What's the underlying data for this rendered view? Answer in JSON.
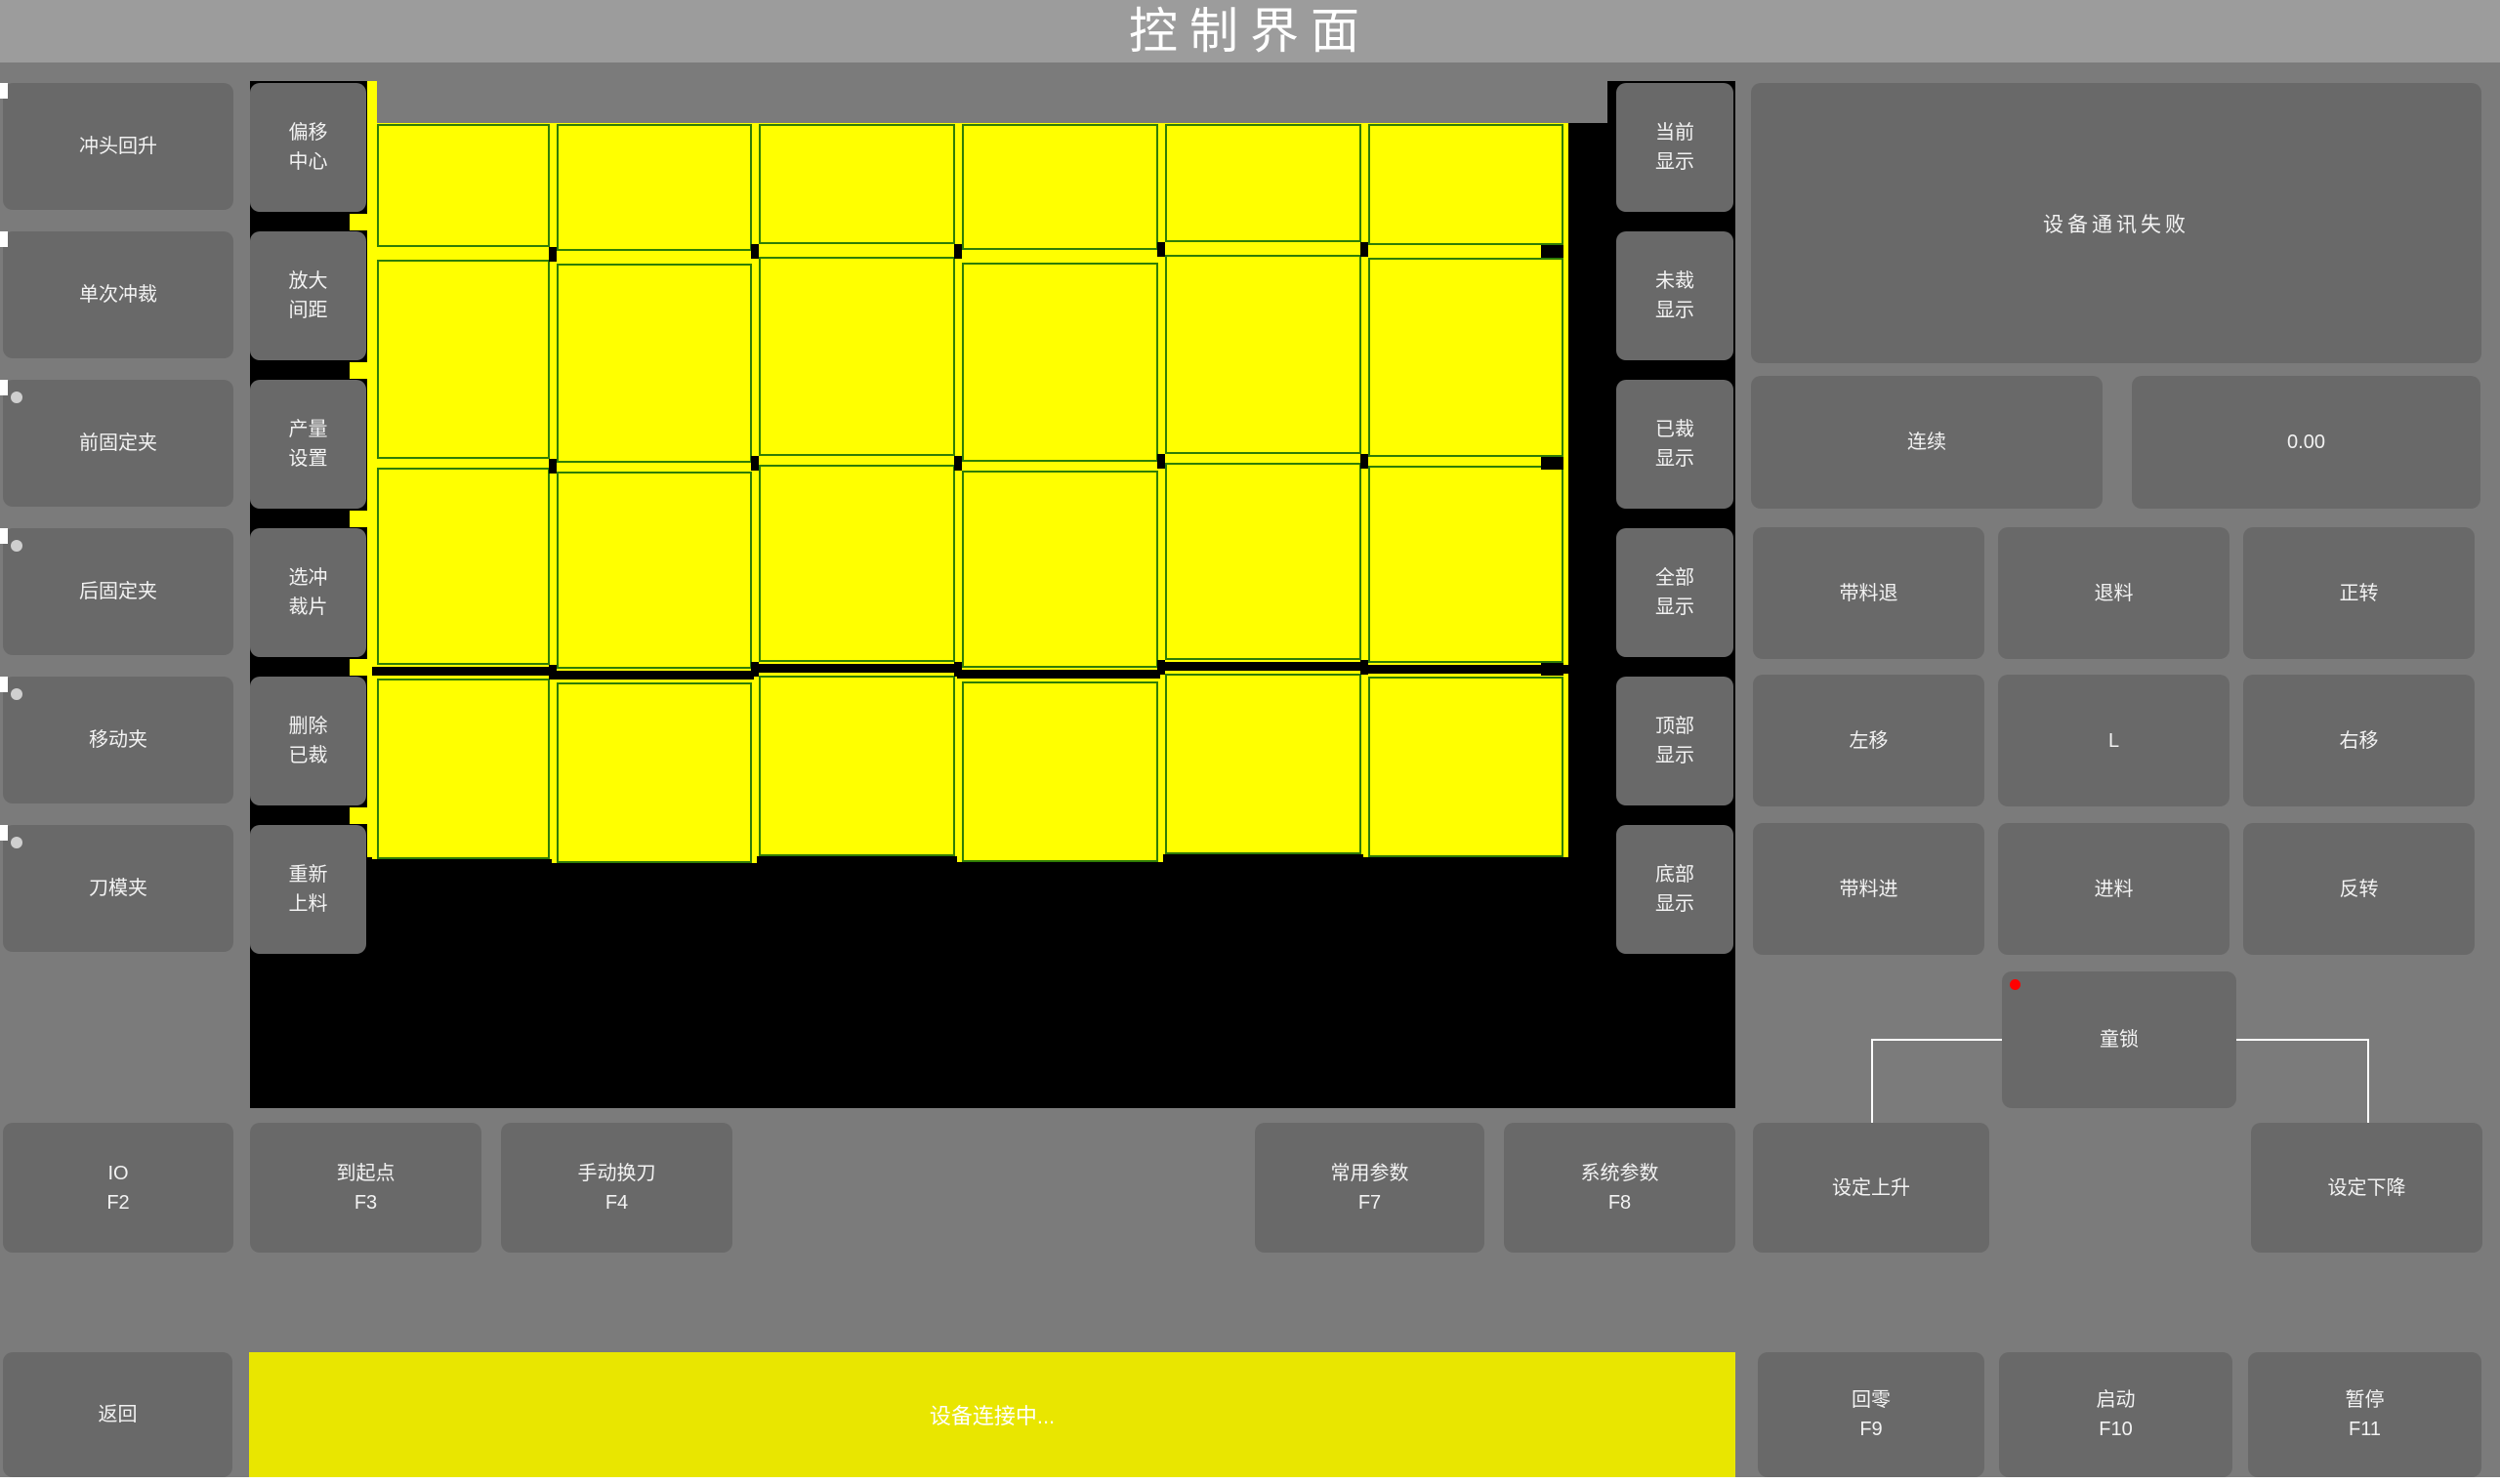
{
  "window": {
    "title": "控制界面"
  },
  "colors": {
    "accent_yellow": "#ffff00",
    "status_bar_yellow": "#e9e600",
    "grid_line_green": "#2f7d05",
    "canvas_black": "#000000",
    "button_gray": "#696969",
    "alarm_red": "#ff0000",
    "indicator_gray": "#cfcfcf"
  },
  "left_buttons": [
    {
      "label": "冲头回升",
      "dot": false
    },
    {
      "label": "单次冲裁",
      "dot": false
    },
    {
      "label": "前固定夹",
      "dot": true
    },
    {
      "label": "后固定夹",
      "dot": true
    },
    {
      "label": "移动夹",
      "dot": true
    },
    {
      "label": "刀模夹",
      "dot": true
    }
  ],
  "tool_buttons": [
    {
      "lines": [
        "偏移",
        "中心"
      ]
    },
    {
      "lines": [
        "放大",
        "间距"
      ]
    },
    {
      "lines": [
        "产量",
        "设置"
      ]
    },
    {
      "lines": [
        "选冲",
        "裁片"
      ]
    },
    {
      "lines": [
        "删除",
        "已裁"
      ]
    },
    {
      "lines": [
        "重新",
        "上料"
      ]
    }
  ],
  "display_buttons": [
    {
      "lines": [
        "当前",
        "显示"
      ]
    },
    {
      "lines": [
        "未裁",
        "显示"
      ]
    },
    {
      "lines": [
        "已裁",
        "显示"
      ]
    },
    {
      "lines": [
        "全部",
        "显示"
      ]
    },
    {
      "lines": [
        "顶部",
        "显示"
      ]
    },
    {
      "lines": [
        "底部",
        "显示"
      ]
    }
  ],
  "piece_grid": {
    "columns": 6,
    "rows": 4
  },
  "right_panel": {
    "message": "设备通讯失败",
    "mode_button": "连续",
    "value_display": "0.00",
    "jog_grid": [
      [
        "带料退",
        "退料",
        "正转"
      ],
      [
        "左移",
        "L",
        "右移"
      ],
      [
        "带料进",
        "进料",
        "反转"
      ]
    ],
    "child_lock": "童锁",
    "set_up": "设定上升",
    "set_down": "设定下降"
  },
  "fkey_buttons": [
    {
      "label": "IO",
      "key": "F2"
    },
    {
      "label": "到起点",
      "key": "F3"
    },
    {
      "label": "手动换刀",
      "key": "F4"
    },
    {
      "label": "常用参数",
      "key": "F7"
    },
    {
      "label": "系统参数",
      "key": "F8"
    }
  ],
  "bottom_bar": {
    "back_button": "返回",
    "status_text": "设备连接中...",
    "buttons": [
      {
        "label": "回零",
        "key": "F9"
      },
      {
        "label": "启动",
        "key": "F10"
      },
      {
        "label": "暂停",
        "key": "F11"
      }
    ]
  }
}
